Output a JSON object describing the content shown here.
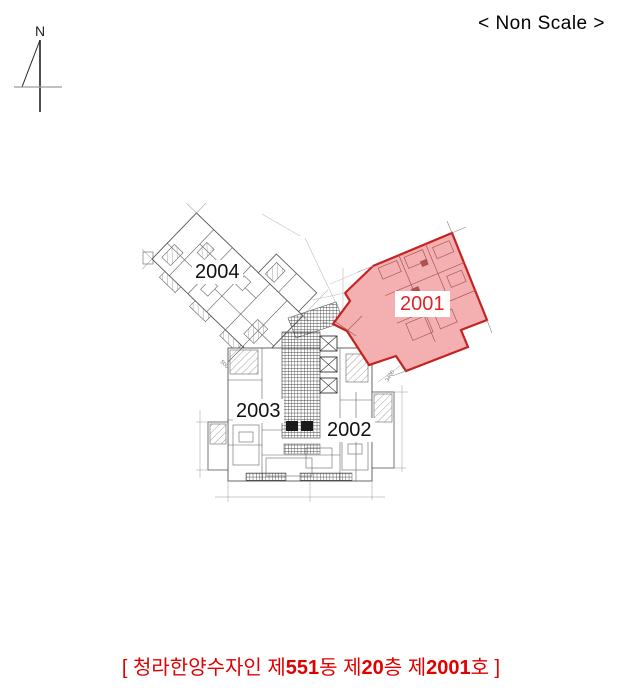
{
  "header": {
    "north_label": "N",
    "scale_note": "< Non Scale >"
  },
  "floor_plan": {
    "units": [
      {
        "label": "2001",
        "highlighted": true
      },
      {
        "label": "2002",
        "highlighted": false
      },
      {
        "label": "2003",
        "highlighted": false
      },
      {
        "label": "2004",
        "highlighted": false
      }
    ],
    "dim_labels": [
      {
        "text": "3400"
      },
      {
        "text": "500"
      }
    ]
  },
  "caption": {
    "full_text": "[ 청라한양수자인 제551동 제20층 제2001호 ]",
    "segments": [
      {
        "text": "[ 청라한양수자인 제",
        "bold": false
      },
      {
        "text": "551",
        "bold": true
      },
      {
        "text": "동 제",
        "bold": false
      },
      {
        "text": "20",
        "bold": true
      },
      {
        "text": "층 제",
        "bold": false
      },
      {
        "text": "2001",
        "bold": true
      },
      {
        "text": "호 ]",
        "bold": false
      }
    ]
  },
  "colors": {
    "highlight_fill": "#f4b0b0",
    "highlight_border": "#c52222",
    "highlight_label": "#e32222",
    "caption_text": "#e00000",
    "plan_lines": "#606060"
  }
}
